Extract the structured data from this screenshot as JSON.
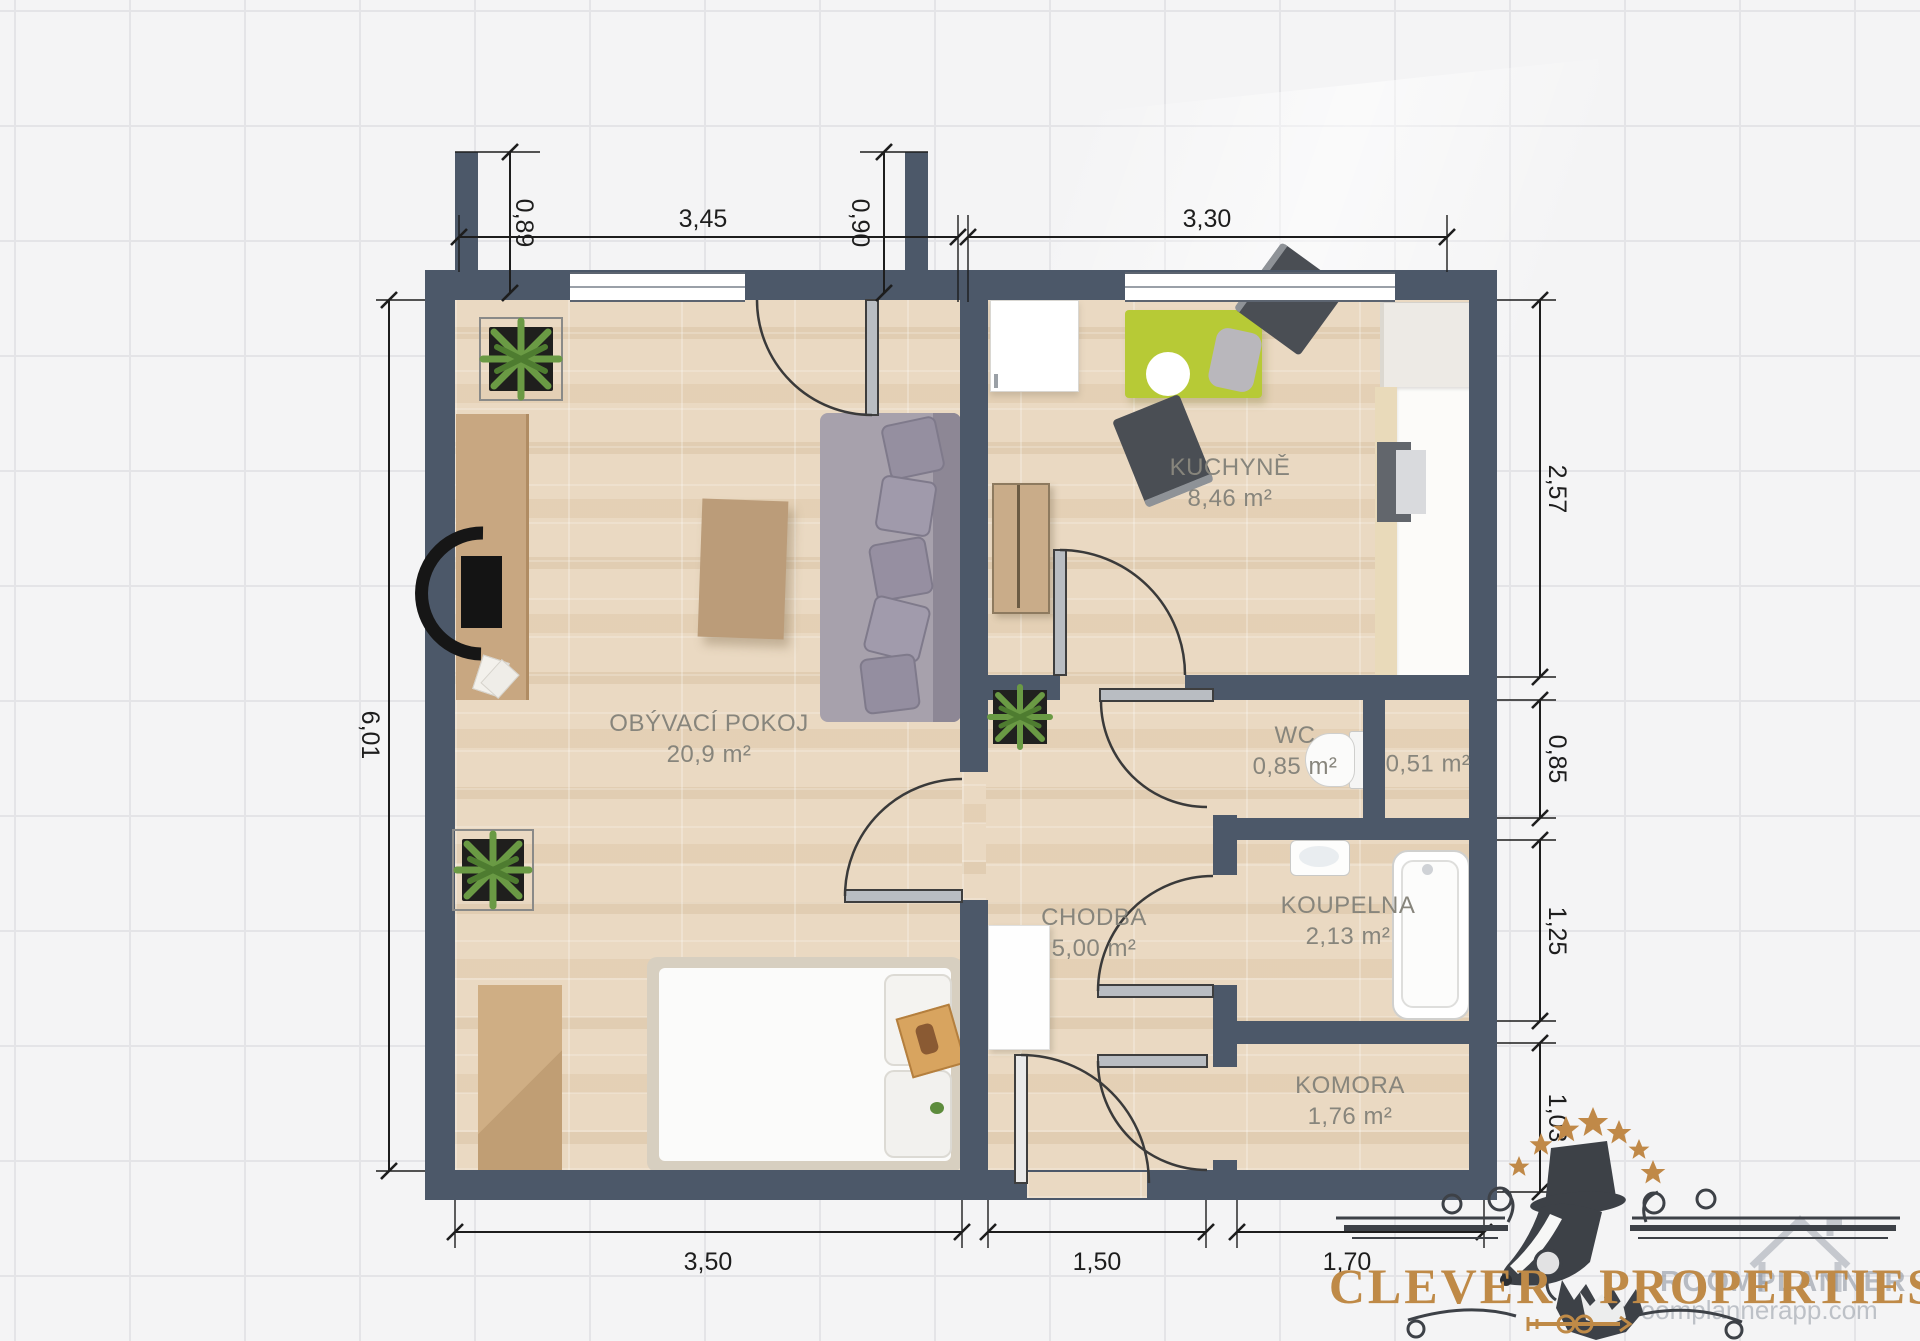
{
  "plan": {
    "rooms": [
      {
        "name": "OBÝVACÍ POKOJ",
        "area": "20,9 m²"
      },
      {
        "name": "KUCHYNĚ",
        "area": "8,46 m²"
      },
      {
        "name": "WC",
        "area": "0,85 m²"
      },
      {
        "name": "",
        "area": "0,51 m²"
      },
      {
        "name": "CHODBA",
        "area": "5,00 m²"
      },
      {
        "name": "KOUPELNA",
        "area": "2,13 m²"
      },
      {
        "name": "KOMORA",
        "area": "1,76 m²"
      }
    ],
    "dimensions": {
      "top": [
        "0,89",
        "3,45",
        "0,90",
        "3,30"
      ],
      "left": [
        "6,01"
      ],
      "right": [
        "2,57",
        "0,85",
        "1,25",
        "1,03"
      ],
      "bottom": [
        "3,50",
        "1,50",
        "1,70"
      ]
    }
  },
  "branding": {
    "name_left": "CLEVER",
    "name_right": "PROPERTIES",
    "watermark_name": "ROOMPLANNER",
    "watermark_domain": "roomplannerapp.com"
  },
  "colors": {
    "wall": "#4c5869",
    "table_accent": "#b7ca36",
    "logo_gold": "#bf8a47"
  }
}
